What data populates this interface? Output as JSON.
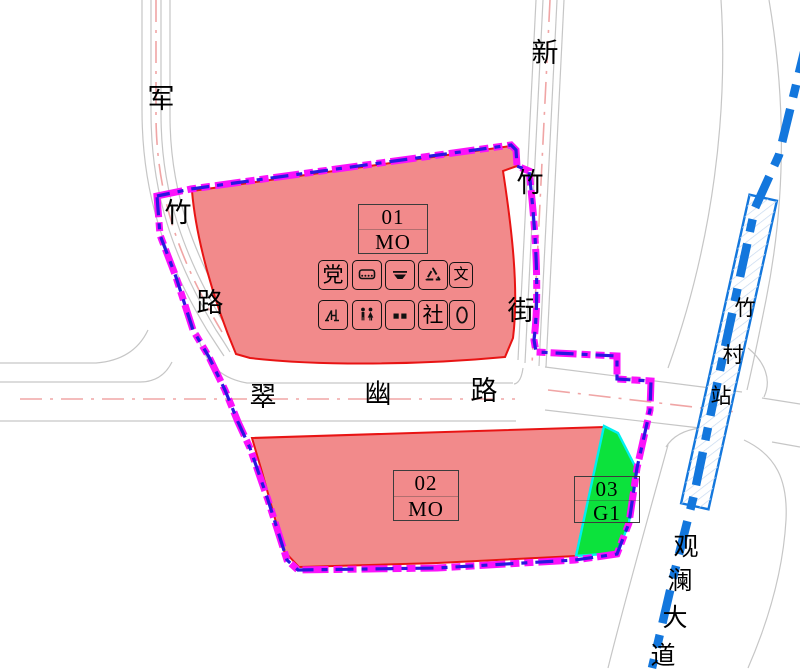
{
  "colors": {
    "parcel-pink": "#f28a8b",
    "parcel-red": "#e81414",
    "parcel-green": "#0ce23c",
    "green-outline-cyan": "#00f0f0",
    "boundary-magenta": "#fb12fb",
    "boundary-blue": "#2a17e0",
    "metro-blue": "#1377dd",
    "station-hatch": "#c7d9ef",
    "road-gray": "#c6c6c6",
    "centerline-pink": "#f0a5a5",
    "text-black": "#0a0a0a"
  },
  "parcels": [
    {
      "number": "01",
      "code": "MO"
    },
    {
      "number": "02",
      "code": "MO"
    },
    {
      "number": "03",
      "code": "G1"
    }
  ],
  "roads": {
    "junzhu": [
      "军",
      "竹",
      "路"
    ],
    "xinzhu": [
      "新",
      "竹",
      "街"
    ],
    "cuiyou": [
      "翠",
      "幽",
      "路"
    ],
    "guanlan": [
      "观",
      "澜",
      "大",
      "道"
    ]
  },
  "station": [
    "竹",
    "村",
    "站"
  ],
  "facility_icons": [
    {
      "name": "party-building-icon",
      "glyph": "党"
    },
    {
      "name": "bus-terminal-icon",
      "glyph": ""
    },
    {
      "name": "refuse-transfer-icon",
      "glyph": ""
    },
    {
      "name": "recycling-station-icon",
      "glyph": ""
    },
    {
      "name": "culture-room-icon",
      "glyph": "文"
    },
    {
      "name": "sports-facility-icon",
      "glyph": ""
    },
    {
      "name": "public-toilet-icon",
      "glyph": ""
    },
    {
      "name": "refuse-collection-icon",
      "glyph": ""
    },
    {
      "name": "community-center-icon",
      "glyph": "社"
    },
    {
      "name": "postal-icon",
      "glyph": ""
    }
  ]
}
